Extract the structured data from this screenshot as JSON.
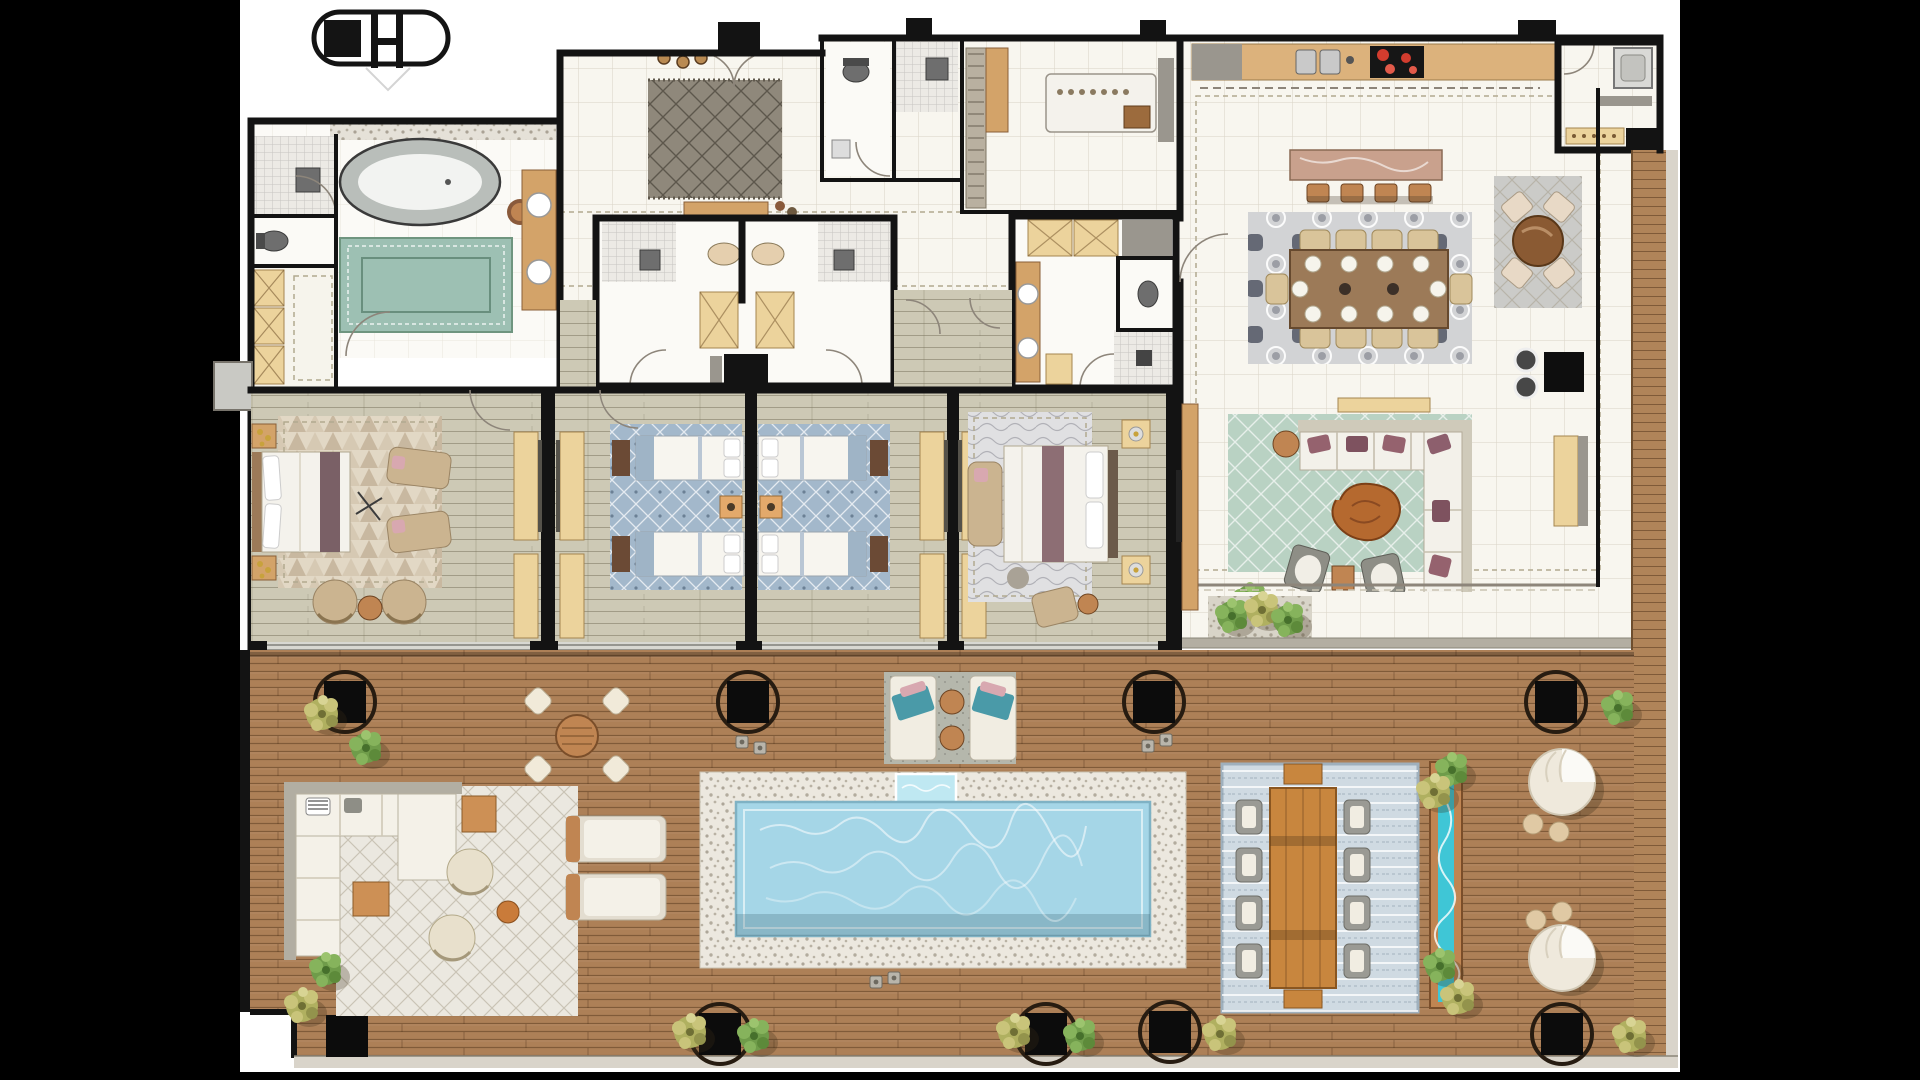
{
  "meta": {
    "kind": "architectural floor plan rendering",
    "view": "top-down penthouse plan with wraparound roof deck and pool",
    "letterbox": "black bars surround white plan sheet"
  },
  "logo": {
    "name": "stadium-monogram-logo",
    "description": "oval capsule outline with solid square and H glyph"
  },
  "palette": {
    "background": "#000000",
    "sheet": "#ffffff",
    "wall": "#131313",
    "tile_floor": "#f8f6ef",
    "bath_floor": "#fbfaf6",
    "bedroom_floor": "#cdc9b5",
    "deck_wood": "#ad8057",
    "boardwalk_wood": "#b08459",
    "pool_pebble": "#ece8df",
    "pool_water": "#a5d6e7",
    "pool_spa": "#bfe8f2",
    "rill_water": "#3fc6d6",
    "rug_foyer": "#8f887b",
    "rug_master": "#e2d8c5",
    "rug_twin": "#a3b8cb",
    "rug_bed3": "#e0e0e2",
    "rug_dining": "#d2d3d5",
    "rug_cards": "#cbcbc8",
    "rug_living": "#b9d2c3",
    "rug_outdoor_lounge": "#ebe8e0",
    "rug_outdoor_dining": "#cfdae2",
    "rug_pool_loungers": "#b5b7ac",
    "marble_island": "#c9a18d",
    "sofa_white": "#f3f1ea",
    "cushion_mauve": "#95626e",
    "plant_green": "#6f9c4a",
    "plant_yellow": "#b0b060",
    "burner_red": "#d23c2e",
    "fascia": "#d9d4ca"
  },
  "rooms": {
    "master_bathroom": {
      "label": "Master bathroom",
      "features": [
        "freestanding oval tub",
        "mosaic shower",
        "WC",
        "wardrobe closet",
        "vanity",
        "green rug"
      ]
    },
    "entry_foyer": {
      "label": "Entry foyer",
      "features": [
        "patterned rug",
        "console table",
        "three pendants",
        "double entry door"
      ]
    },
    "guest_baths": {
      "label": "Guest bathrooms"
    },
    "laundry": {
      "label": "Laundry room",
      "features": [
        "folding island with button row",
        "cabinet run",
        "basket"
      ]
    },
    "twin_bath_block": {
      "label": "Back-to-back twin bathrooms"
    },
    "bed3_bathroom": {
      "label": "Bedroom three bathroom",
      "features": [
        "two X-front wardrobes",
        "double vanity",
        "WC",
        "mosaic shower",
        "bench"
      ]
    },
    "kitchen": {
      "label": "Kitchen",
      "features": [
        "wall counter",
        "double sink",
        "cooktop with red burners",
        "stone island"
      ],
      "island_stools": 4
    },
    "dining": {
      "label": "Dining area",
      "seats": 10
    },
    "card_corner": {
      "label": "Games table corner",
      "seats": 4
    },
    "living": {
      "label": "Living room",
      "features": [
        "L-sectional sofa",
        "live-edge coffee table",
        "two swivel chairs",
        "console",
        "fireplace with two kettles",
        "bench"
      ]
    },
    "ne_entry": {
      "label": "Service entry lobby",
      "features": [
        "lift shaft",
        "dotted bench",
        "mat"
      ]
    },
    "boardwalk": {
      "label": "East timber boardwalk"
    },
    "master_bedroom": {
      "label": "Master bedroom",
      "beds": 1,
      "features": [
        "king bed",
        "two chaises",
        "two round chairs",
        "triangle-pattern rug"
      ]
    },
    "bedroom_2a": {
      "label": "Twin bedroom A",
      "beds": 2
    },
    "bedroom_2b": {
      "label": "Twin bedroom B",
      "beds": 2
    },
    "bedroom_3": {
      "label": "Guest bedroom",
      "beds": 1,
      "features": [
        "chaise",
        "armchair",
        "wavy rug"
      ]
    },
    "roof_deck": {
      "label": "Roof deck",
      "features": [
        "timber decking",
        "ringed structural columns",
        "potted plants",
        "lanterns"
      ]
    },
    "pool": {
      "label": "Swimming pool",
      "features": [
        "pebble surround",
        "spa inset"
      ]
    },
    "bistro_set": {
      "label": "Bistro table",
      "seats": 4
    },
    "outdoor_lounge": {
      "label": "Outdoor lounge",
      "features": [
        "L-sofa",
        "two round chairs",
        "wood side tables",
        "ottoman"
      ]
    },
    "west_loungers": {
      "label": "Sun loungers west",
      "count": 2
    },
    "pool_loungers": {
      "label": "Sun loungers by spa",
      "count": 2,
      "features": [
        "towels",
        "two round tables"
      ]
    },
    "outdoor_dining": {
      "label": "Outdoor dining table",
      "side_chairs": 8,
      "end_benches": 2
    },
    "rill_planter": {
      "label": "Planter with water rill"
    },
    "daybeds": {
      "label": "Round canopy daybeds",
      "count": 2,
      "poufs_each": 2
    }
  },
  "counts": {
    "ring_columns_top_row": 4,
    "ring_columns_bottom_row": 4,
    "corner_column": 1,
    "plants_on_deck": 14
  }
}
